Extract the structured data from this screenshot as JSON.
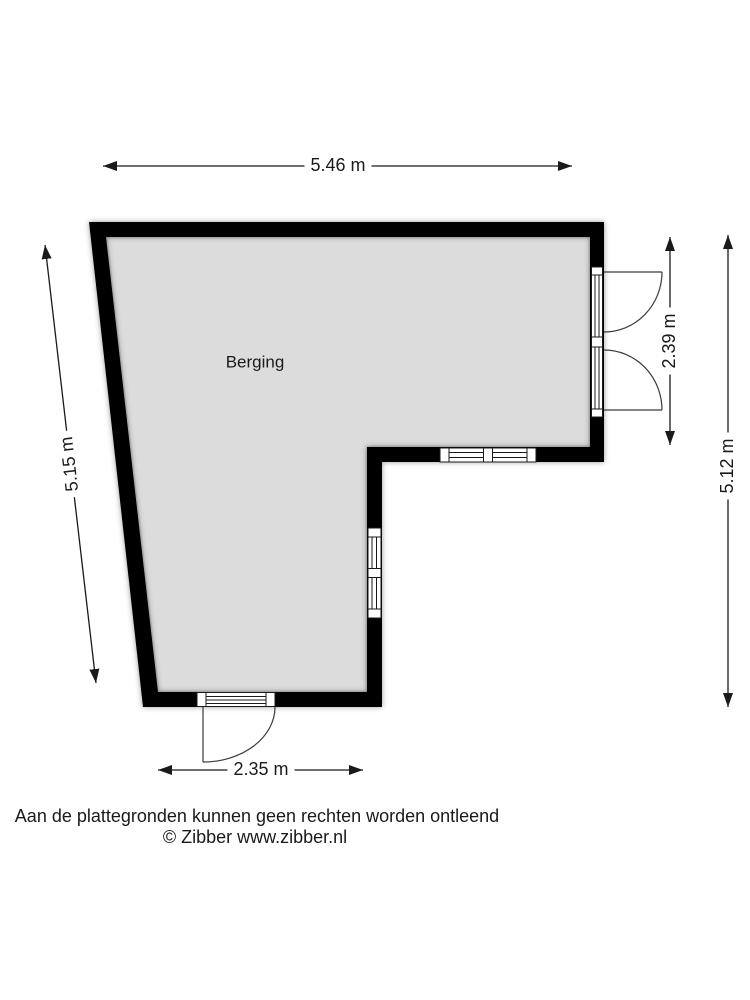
{
  "floor_plan": {
    "room_label": "Berging",
    "dimensions": {
      "top_width": "5.46 m",
      "left_height": "5.15 m",
      "right_door_height": "2.39 m",
      "right_height": "5.12 m",
      "bottom_door_width": "2.35 m"
    },
    "colors": {
      "wall": "#000000",
      "floor": "#dcdcdc",
      "floor_edge": "#c9c9c9",
      "opening_line": "#1a1a1a",
      "door_swing_line": "#3a3a3a",
      "dimension_line": "#1a1a1a",
      "background": "#ffffff"
    }
  },
  "footer": {
    "disclaimer": "Aan de plattegronden kunnen geen rechten worden ontleend",
    "credit": "© Zibber www.zibber.nl"
  }
}
